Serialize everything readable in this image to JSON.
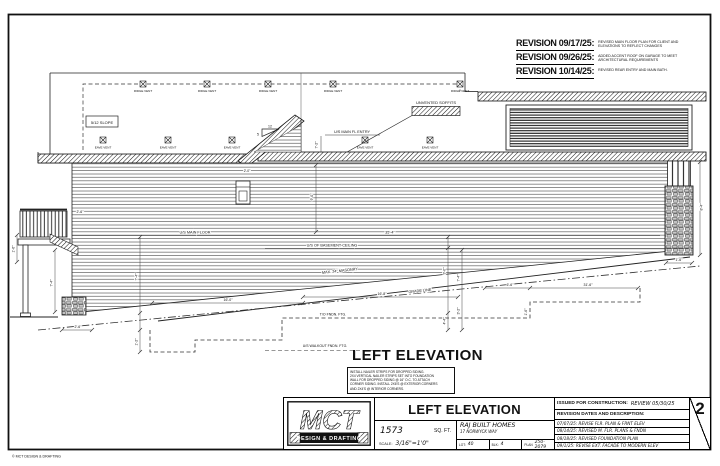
{
  "sheet": {
    "watermark": "© MCT DESIGN & DRAFTING",
    "sheet_number": "2"
  },
  "top_revisions": [
    {
      "title": "REVISION 09/17/25:",
      "line1": "REVISED MAIN FLOOR PLAN FOR CLIENT AND",
      "line2": "ELEVATIONS TO REFLECT CHANGES"
    },
    {
      "title": "REVISION 09/26/25:",
      "line1": "ADDED ACCENT ROOF ON GARAGE TO MEET",
      "line2": "ARCHITECTURAL REQUIREMENTS"
    },
    {
      "title": "REVISION 10/14/25:",
      "line1": "REVISED REAR ENTRY AND MAIN BATH.",
      "line2": ""
    }
  ],
  "drawing": {
    "labels": {
      "slope_box": "5/12 SLOPE",
      "ridge_vent": "RIDGE VENT",
      "eave_vent": "EAVE VENT",
      "unvented_soffits": "UNVENTED SOFFITS",
      "slope_run": "12",
      "slope_rise": "5",
      "us_main_fl_entry": "U/S MAIN FL ENTRY",
      "us_main_floor": "U/S MAIN FLOOR",
      "us_basement_ceiling": "U/S OF BASEMENT CEILING",
      "masonry": "MAX. 24\" MASONRY",
      "grade_line": "GRADE LINE",
      "to_fndn_ftg": "T/O FNDN. FTG.",
      "us_walkout_ftg": "U/S WALKOUT FNDN. FTG."
    },
    "dims": {
      "entry_height": "7'-2\"",
      "clerestory_wall": "9'-0\"",
      "step_offset": "2'-0\"",
      "main_floor_span": "35'-4\"",
      "deck_rail": "2'-6\"",
      "deck_left": "1'-6\"",
      "deck_post": "7'-4\"",
      "deck_base": "2'-6\"",
      "left_step": "7'-4\"",
      "left_ftg": "1'-2\"",
      "walkout_span": "16'-0\"",
      "mid_span": "16'-8\"",
      "mid_height_a": "9'-0\"",
      "mid_height_b": "7'-4\"",
      "mid_height_c": "4'-4\"",
      "mid_height_d": "3'-2\"",
      "ftg_left": "6'-6\"",
      "ftg_right": "31'-6\"",
      "ftg_step": "1'-6\"",
      "pier_width": "1'-6\"",
      "pier_height": "8'-4\""
    }
  },
  "elevation_heading": "LEFT ELEVATION",
  "note_box": {
    "lines": [
      "INSTALL NAILER STRIPS FOR DROPPED SIDING.",
      "2x4 VERTICAL NAILER STRIPS SET INTO FOUNDATION",
      "WALL FOR DROPPED SIDING @ 16\" O.C. TO ATTACH",
      "CORNER SIDING. INSTALL 2x6's @ EXTERIOR CORNERS",
      "AND 2x4's @ INTERIOR CORNERS."
    ]
  },
  "title_block": {
    "logo_text": "MCT",
    "logo_sub": "DESIGN & DRAFTING",
    "drawing_title": "LEFT ELEVATION",
    "area_value": "1573",
    "area_unit": "SQ. FT.",
    "scale_label": "SCALE:",
    "scale_value": "3/16\"=1'0\"",
    "client": "RAJ BUILT HOMES",
    "address": "17 NORWYCK WAY",
    "lot_label": "LOT:",
    "lot_value": "40",
    "blk_label": "BLK:",
    "blk_value": "4",
    "plan_label": "PLAN",
    "plan_value": "250-2079",
    "issued_label": "ISSUED FOR CONSTRUCTION:",
    "issued_value": "REVIEW 05/30/25",
    "revision_header": "REVISION DATES AND DESCRIPTION:",
    "revisions": [
      "07/07/25: REVISE FLR. PLAN & FRNT ELEV",
      "08/14/25: REVISED M. FLR. PLANS & FNDN",
      "08/18/25: REVISED FOUNDATION PLAN",
      "09/1/25: REVISE EXT. FACADE TO MODERN ELEV"
    ],
    "sheet_number": "2"
  }
}
